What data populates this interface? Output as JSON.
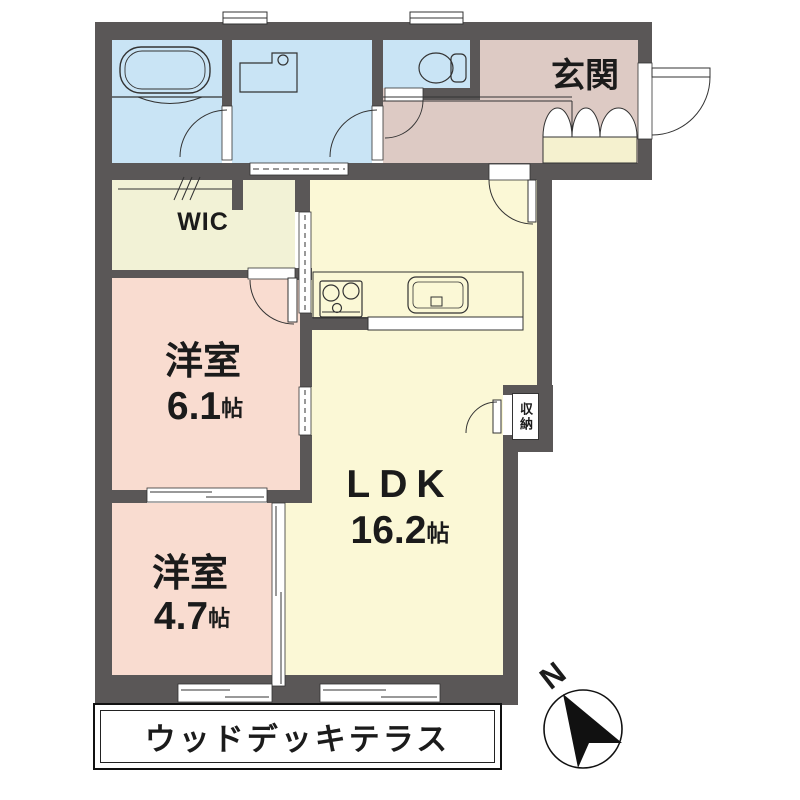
{
  "rooms": {
    "entrance": {
      "label": "玄関"
    },
    "wic": {
      "label": "WIC"
    },
    "ldk": {
      "label": "LDK",
      "size_value": "16.2",
      "size_unit": "帖"
    },
    "bedroom_6_1": {
      "label": "洋室",
      "size_value": "6.1",
      "size_unit": "帖"
    },
    "bedroom_4_7": {
      "label": "洋室",
      "size_value": "4.7",
      "size_unit": "帖"
    },
    "storage": {
      "label": "収納"
    },
    "wood_deck": {
      "label": "ウッドデッキテラス"
    }
  },
  "compass": {
    "north_label": "N"
  },
  "colors": {
    "wall": "#5a5757",
    "water": "#c9e4f5",
    "bedroom": "#f9dcd0",
    "entrance": "#ddcac4",
    "ldk": "#fbf8d6",
    "wic": "#f2f2d6",
    "cabinet": "#f5f1cf",
    "line": "#333333"
  }
}
